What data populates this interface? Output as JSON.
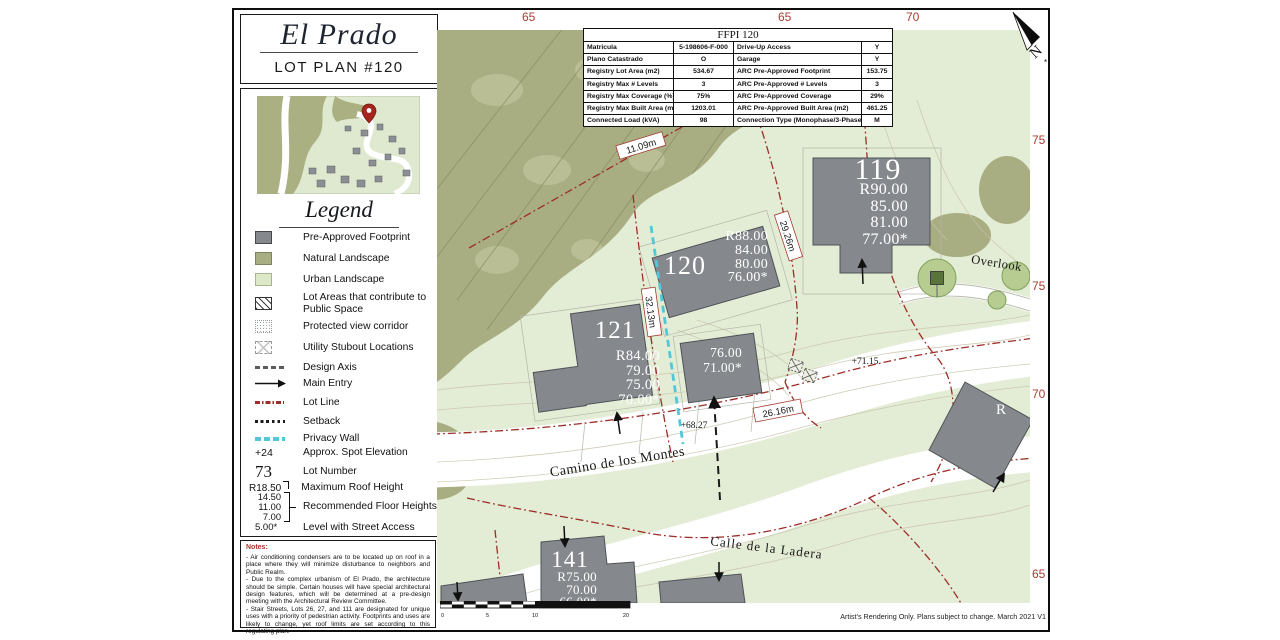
{
  "title_block": {
    "project": "El Prado",
    "subtitle": "LOT PLAN #120"
  },
  "info_table": {
    "header": "FFPI 120",
    "rows": [
      {
        "l1": "Matricula",
        "v1": "5-198606-F-000",
        "l2": "Drive-Up Access",
        "v2": "Y"
      },
      {
        "l1": "Plano Catastrado",
        "v1": "O",
        "l2": "Garage",
        "v2": "Y"
      },
      {
        "l1": "Registry Lot Area (m2)",
        "v1": "534.67",
        "l2": "ARC Pre-Approved Footprint",
        "v2": "153.75"
      },
      {
        "l1": "Registry Max # Levels",
        "v1": "3",
        "l2": "ARC Pre-Approved # Levels",
        "v2": "3"
      },
      {
        "l1": "Registry Max Coverage (%)",
        "v1": "75%",
        "l2": "ARC Pre-Approved Coverage",
        "v2": "29%"
      },
      {
        "l1": "Registry Max Built Area (m2)",
        "v1": "1203.01",
        "l2": "ARC Pre-Approved Built Area (m2)",
        "v2": "461.25"
      },
      {
        "l1": "Connected Load (kVA)",
        "v1": "98",
        "l2": "Connection Type (Monophase/3-Phase)",
        "v2": "M"
      }
    ]
  },
  "legend": {
    "heading": "Legend",
    "items": [
      {
        "label": "Pre-Approved Footprint"
      },
      {
        "label": "Natural Landscape"
      },
      {
        "label": "Urban Landscape"
      },
      {
        "label": "Lot Areas that contribute to Public Space"
      },
      {
        "label": "Protected view corridor"
      },
      {
        "label": "Utility Stubout Locations"
      },
      {
        "label": "Design Axis"
      },
      {
        "label": "Main Entry"
      },
      {
        "label": "Lot Line"
      },
      {
        "label": "Setback"
      },
      {
        "label": "Privacy Wall"
      },
      {
        "symbol": "+24",
        "label": "Approx. Spot Elevation"
      },
      {
        "symbol": "73",
        "label": "Lot Number"
      },
      {
        "symbol": "R18.50",
        "label": "Maximum Roof Height"
      },
      {
        "label": "Recommended Floor Heights"
      },
      {
        "symbol": "5.00*",
        "label": "Level with Street Access"
      }
    ],
    "floor_heights": [
      "14.50",
      "11.00",
      "7.00"
    ]
  },
  "notes": {
    "heading": "Notes:",
    "items": [
      "- Air conditioning condensers are to be located up on roof in a place where they will minimize disturbance to neighbors and Public Realm.",
      "- Due to the complex urbanism of El Prado, the architecture should be simple. Certain houses will have special architectural design features, which will be determined at a pre-design meeting with the Architectural Review Committee.",
      "- Stair Streets, Lots 26, 27, and 111 are designated for unique uses with a priority of pedestrian activity. Footprints and uses are likely to change, yet roof limits are set according to this regulating plan."
    ]
  },
  "map": {
    "contour_labels_top": [
      "65",
      "65",
      "70"
    ],
    "contour_labels_right": [
      "75",
      "75",
      "70",
      "65"
    ],
    "streets": [
      "Camino de los Montes",
      "Calle de la Ladera"
    ],
    "overlook_label": "Overlook",
    "compass": "N",
    "lots": [
      {
        "number": "119",
        "heights": [
          "R90.00",
          "85.00",
          "81.00",
          "77.00*"
        ]
      },
      {
        "number": "120",
        "heights": [
          "R88.00",
          "84.00",
          "80.00",
          "76.00*"
        ]
      },
      {
        "number": "121",
        "heights": [
          "R84.00",
          "79.00",
          "75.00",
          "70.00*"
        ]
      },
      {
        "number": "141",
        "heights": [
          "R75.00",
          "70.00",
          "66.00*"
        ]
      }
    ],
    "sub_lot_heights": [
      "76.00",
      "71.00*"
    ],
    "partial_lot_label": "R",
    "measurements": [
      "11.09m",
      "32.13m",
      "29.26m",
      "26.16m"
    ],
    "spot_elevations": [
      "+71.15",
      "+68.27"
    ],
    "scale_ticks": [
      "0",
      "5",
      "10",
      "20"
    ]
  },
  "footer": {
    "disclaimer": "Artist's Rendering Only. Plans subject to change. March 2021 V1"
  },
  "colors": {
    "lot_line": "#9c2e27",
    "privacy_wall": "#53c6da",
    "footprint": "#85888c",
    "natural_landscape": "#a8ad82",
    "urban_landscape": "#e3ecd5",
    "contour_label": "#aa3c30"
  }
}
